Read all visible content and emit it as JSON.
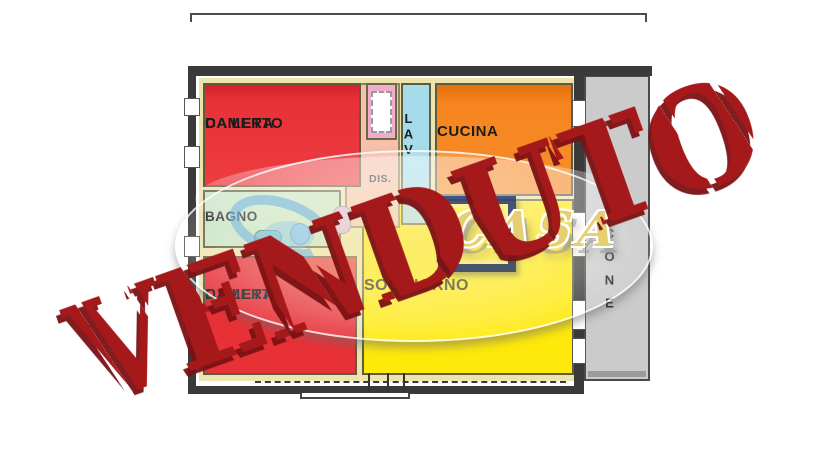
{
  "stamp": {
    "text": "VENDUTO",
    "color": "#a5191b",
    "shadow_color": "#7a1013"
  },
  "agency_watermark": {
    "text": "CASA",
    "text_color": "#e6cf72"
  },
  "floorplan": {
    "rooms": {
      "bedroom_top": {
        "label_line1": "CAMERA",
        "label_line2": "DA LETTO",
        "color": "#e73137"
      },
      "kitchen": {
        "label": "CUCINA",
        "color": "#f6851f"
      },
      "laundry": {
        "label": "LAV",
        "color": "#a6dbea"
      },
      "bathroom": {
        "label": "BAGNO",
        "color": "#c8e4c2"
      },
      "hallway": {
        "label": "DIS.",
        "color": "#f6c0ab"
      },
      "living_room": {
        "label": "SOGGIORNO",
        "color": "#ffe90a"
      },
      "bedroom_bottom": {
        "label_line1": "CAMERA",
        "label_line2": "DA LETTO",
        "color": "#e73137"
      },
      "balcony": {
        "label": "BALCONE",
        "color": "#cbcbcb"
      }
    }
  }
}
